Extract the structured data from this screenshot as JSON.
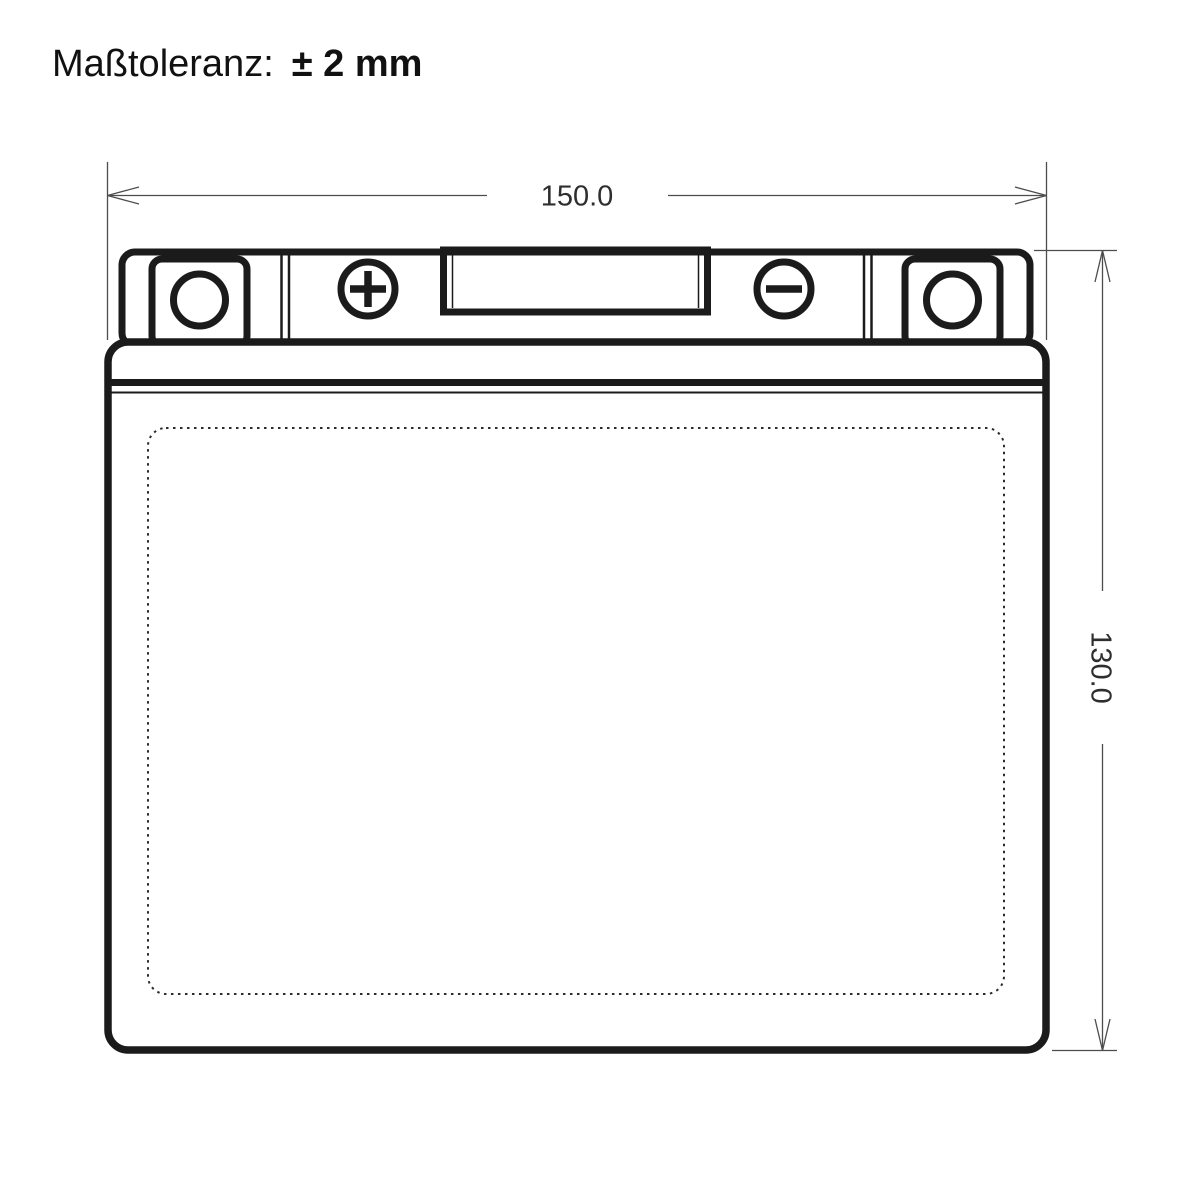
{
  "title": {
    "label": "Maßtoleranz:",
    "tolerance": "± 2 mm"
  },
  "drawing": {
    "subject": "battery-outline-front-view",
    "width_mm": "150.0",
    "height_mm": "130.0",
    "icons": {
      "positive_terminal": "plus-terminal-icon",
      "negative_terminal": "minus-terminal-icon",
      "left_vent": "left-vent-port-icon",
      "right_vent": "right-vent-port-icon"
    },
    "colors": {
      "outline": "#1b1b1b",
      "dimension_line": "#4d4d4d",
      "dimension_text": "#2e2e2e",
      "background": "#ffffff"
    }
  }
}
